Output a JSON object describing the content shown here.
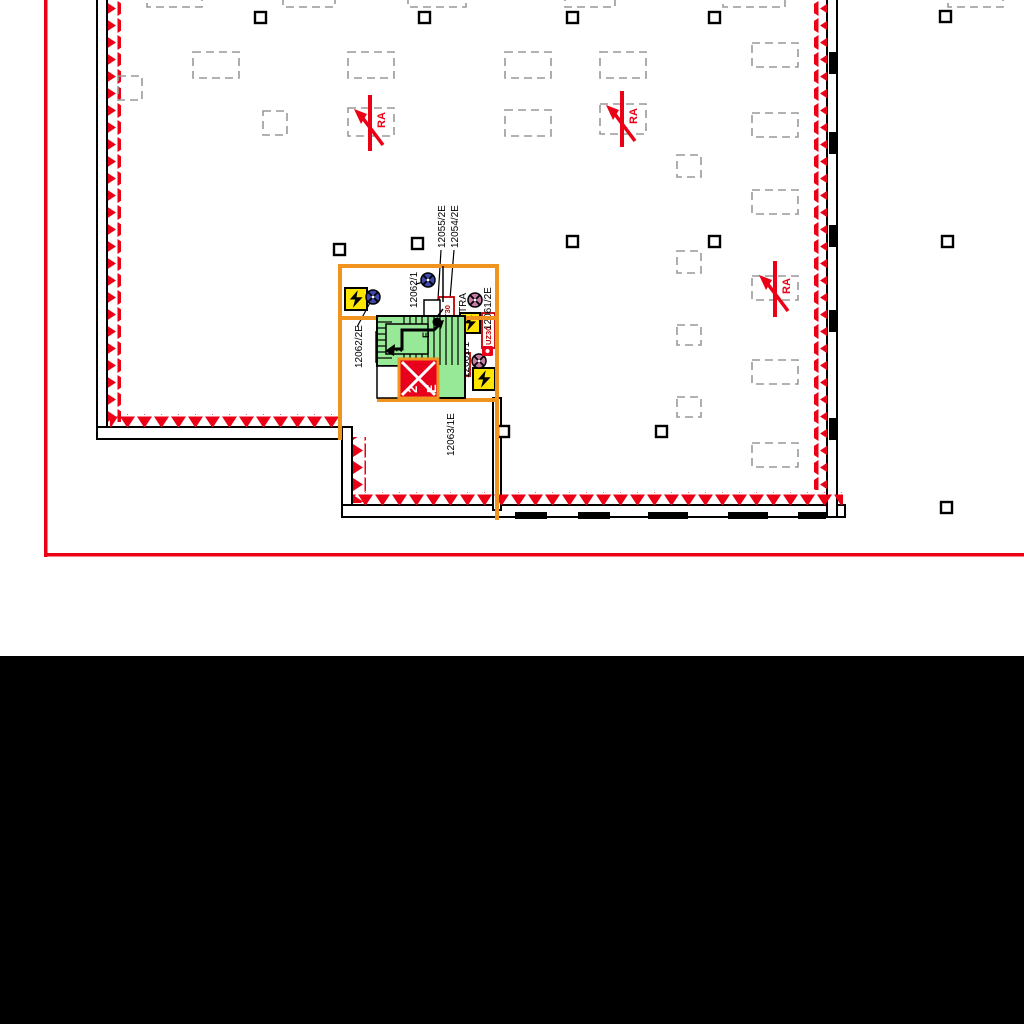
{
  "colors": {
    "drawing_border": "#ec0016",
    "fire_marking": "#ec0016",
    "escape_route_orange": "#f0931f",
    "stairwell_fill": "#97e897",
    "hazard_yellow": "#ffe600",
    "exit_red": "#e8001c",
    "lamp_blue": "#3d49ae",
    "lamp_pink": "#c87ba6",
    "lamp_green": "#2f9e33",
    "opening_gray": "#999999",
    "mask_black": "#000000"
  },
  "plan": {
    "smoke_vents": [
      {
        "label": "RA",
        "x": 370,
        "y": 122
      },
      {
        "label": "RA",
        "x": 622,
        "y": 118
      },
      {
        "label": "RA",
        "x": 775,
        "y": 288
      }
    ],
    "device_labels": [
      {
        "text": "12062/2E",
        "x": 354,
        "y": 368
      },
      {
        "text": "12062/1",
        "x": 409,
        "y": 308
      },
      {
        "text": "12055/2E",
        "x": 437,
        "y": 248
      },
      {
        "text": "12054/2E",
        "x": 450,
        "y": 248
      },
      {
        "text": "TRA",
        "x": 458,
        "y": 313
      },
      {
        "text": "12061/2E",
        "x": 483,
        "y": 330
      },
      {
        "text": "12061/1",
        "x": 461,
        "y": 378
      },
      {
        "text": "12063/1E",
        "x": 446,
        "y": 456
      }
    ],
    "door_labels": [
      {
        "text": "T30",
        "bx": 439,
        "by": 297,
        "bw": 15,
        "bh": 24
      },
      {
        "text": "T30",
        "bx": 376,
        "by": 332,
        "bw": 16,
        "bh": 30
      },
      {
        "text": "T30",
        "bx": 457,
        "by": 353,
        "bw": 13,
        "bh": 23
      },
      {
        "text": "UZ30",
        "bx": 482,
        "by": 313,
        "bw": 13,
        "bh": 35
      }
    ],
    "exit_sign": {
      "route_number": "2",
      "exit_letter": "E"
    },
    "stair": {
      "route_number": "2",
      "exit_letter": "E"
    },
    "lamps": [
      {
        "kind": "safety-light",
        "color": "lamp_blue",
        "x": 373,
        "y": 297
      },
      {
        "kind": "safety-light",
        "color": "lamp_blue",
        "x": 428,
        "y": 280
      },
      {
        "kind": "safety-light",
        "color": "lamp_blue",
        "x": 446,
        "y": 343
      },
      {
        "kind": "safety-light",
        "color": "lamp_pink",
        "x": 475,
        "y": 300
      },
      {
        "kind": "safety-light",
        "color": "lamp_pink",
        "x": 479,
        "y": 361
      },
      {
        "kind": "safety-light",
        "color": "lamp_green",
        "x": 447,
        "y": 382
      }
    ],
    "hazard_boxes": [
      {
        "x": 345,
        "y": 288,
        "s": 22
      },
      {
        "x": 460,
        "y": 313,
        "s": 20
      },
      {
        "x": 473,
        "y": 368,
        "s": 22
      }
    ],
    "openings": [
      {
        "x": 193,
        "y": 52,
        "w": 46,
        "h": 26
      },
      {
        "x": 348,
        "y": 52,
        "w": 46,
        "h": 26
      },
      {
        "x": 505,
        "y": 52,
        "w": 46,
        "h": 26
      },
      {
        "x": 600,
        "y": 52,
        "w": 46,
        "h": 26
      },
      {
        "x": 348,
        "y": 108,
        "w": 46,
        "h": 28
      },
      {
        "x": 505,
        "y": 110,
        "w": 46,
        "h": 26
      },
      {
        "x": 600,
        "y": 104,
        "w": 46,
        "h": 30
      },
      {
        "x": 752,
        "y": 43,
        "w": 46,
        "h": 24
      },
      {
        "x": 752,
        "y": 113,
        "w": 46,
        "h": 24
      },
      {
        "x": 752,
        "y": 190,
        "w": 46,
        "h": 24
      },
      {
        "x": 752,
        "y": 276,
        "w": 46,
        "h": 24
      },
      {
        "x": 752,
        "y": 360,
        "w": 46,
        "h": 24
      },
      {
        "x": 752,
        "y": 443,
        "w": 46,
        "h": 24
      },
      {
        "x": 118,
        "y": 76,
        "w": 24,
        "h": 24
      },
      {
        "x": 263,
        "y": 111,
        "w": 24,
        "h": 24
      },
      {
        "x": 677,
        "y": 155,
        "w": 24,
        "h": 22
      },
      {
        "x": 677,
        "y": 251,
        "w": 24,
        "h": 22
      },
      {
        "x": 677,
        "y": 325,
        "w": 24,
        "h": 20
      },
      {
        "x": 677,
        "y": 397,
        "w": 24,
        "h": 20
      },
      {
        "x": 147,
        "y": -4,
        "w": 55,
        "h": 11
      },
      {
        "x": 283,
        "y": -4,
        "w": 52,
        "h": 11
      },
      {
        "x": 408,
        "y": -4,
        "w": 58,
        "h": 11
      },
      {
        "x": 565,
        "y": -4,
        "w": 50,
        "h": 11
      },
      {
        "x": 723,
        "y": -4,
        "w": 62,
        "h": 11
      },
      {
        "x": 948,
        "y": -4,
        "w": 55,
        "h": 11
      }
    ],
    "columns": [
      {
        "x": 255,
        "y": 12
      },
      {
        "x": 419,
        "y": 12
      },
      {
        "x": 567,
        "y": 12
      },
      {
        "x": 709,
        "y": 12
      },
      {
        "x": 940,
        "y": 11
      },
      {
        "x": 334,
        "y": 244
      },
      {
        "x": 412,
        "y": 238
      },
      {
        "x": 567,
        "y": 236
      },
      {
        "x": 709,
        "y": 236
      },
      {
        "x": 942,
        "y": 236
      },
      {
        "x": 498,
        "y": 426
      },
      {
        "x": 656,
        "y": 426
      },
      {
        "x": 941,
        "y": 502
      }
    ],
    "door_segments": [
      {
        "x": 829,
        "y": 52,
        "w": 7,
        "h": 22
      },
      {
        "x": 829,
        "y": 132,
        "w": 7,
        "h": 22
      },
      {
        "x": 829,
        "y": 225,
        "w": 7,
        "h": 22
      },
      {
        "x": 829,
        "y": 310,
        "w": 7,
        "h": 22
      },
      {
        "x": 829,
        "y": 418,
        "w": 7,
        "h": 22
      },
      {
        "x": 515,
        "y": 512,
        "w": 32,
        "h": 7
      },
      {
        "x": 578,
        "y": 512,
        "w": 32,
        "h": 7
      },
      {
        "x": 648,
        "y": 512,
        "w": 40,
        "h": 7
      },
      {
        "x": 728,
        "y": 512,
        "w": 40,
        "h": 7
      },
      {
        "x": 798,
        "y": 512,
        "w": 28,
        "h": 7
      }
    ],
    "leaders": [
      {
        "x1": 372,
        "y1": 299,
        "x2": 357,
        "y2": 327
      },
      {
        "x1": 427,
        "y1": 281,
        "x2": 416,
        "y2": 284
      },
      {
        "x1": 441,
        "y1": 250,
        "x2": 437,
        "y2": 316
      },
      {
        "x1": 454,
        "y1": 250,
        "x2": 447,
        "y2": 336
      },
      {
        "x1": 450,
        "y1": 396,
        "x2": 448,
        "y2": 386
      }
    ]
  }
}
